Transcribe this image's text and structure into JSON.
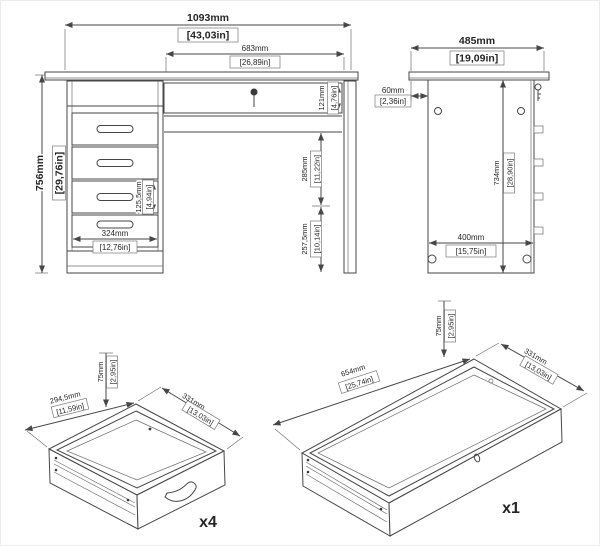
{
  "colors": {
    "background": "#ffffff",
    "line": "#474747",
    "text": "#262626"
  },
  "front": {
    "overall_width": {
      "mm": "1093mm",
      "in": "[43,03in]"
    },
    "desktop_width": {
      "mm": "683mm",
      "in": "[26,89in]"
    },
    "overall_height": {
      "mm": "756mm",
      "in": "[29,76in]"
    },
    "top_drawer_height": {
      "mm": "121mm",
      "in": "[4,76in]"
    },
    "drawer_front_height": {
      "mm": "125,5mm",
      "in": "[4,94in]"
    },
    "pedestal_width": {
      "mm": "324mm",
      "in": "[12,76in]"
    },
    "knee_space_upper": {
      "mm": "285mm",
      "in": "[11,22in]"
    },
    "knee_space_lower": {
      "mm": "257,5mm",
      "in": "[10,14in]"
    }
  },
  "side": {
    "depth": {
      "mm": "485mm",
      "in": "[19,09in]"
    },
    "top_setback": {
      "mm": "60mm",
      "in": "[2,36in]"
    },
    "panel_height": {
      "mm": "734mm",
      "in": "[28,90in]"
    },
    "base_depth": {
      "mm": "400mm",
      "in": "[15,75in]"
    }
  },
  "small_drawer": {
    "quantity": "x4",
    "height": {
      "mm": "75mm",
      "in": "[2,95in]"
    },
    "width": {
      "mm": "294,5mm",
      "in": "[11,59in]"
    },
    "depth": {
      "mm": "331mm",
      "in": "[13,03in]"
    }
  },
  "large_drawer": {
    "quantity": "x1",
    "height": {
      "mm": "75mm",
      "in": "[2,95in]"
    },
    "width": {
      "mm": "654mm",
      "in": "[25,74in]"
    },
    "depth": {
      "mm": "331mm",
      "in": "[13,03in]"
    }
  }
}
